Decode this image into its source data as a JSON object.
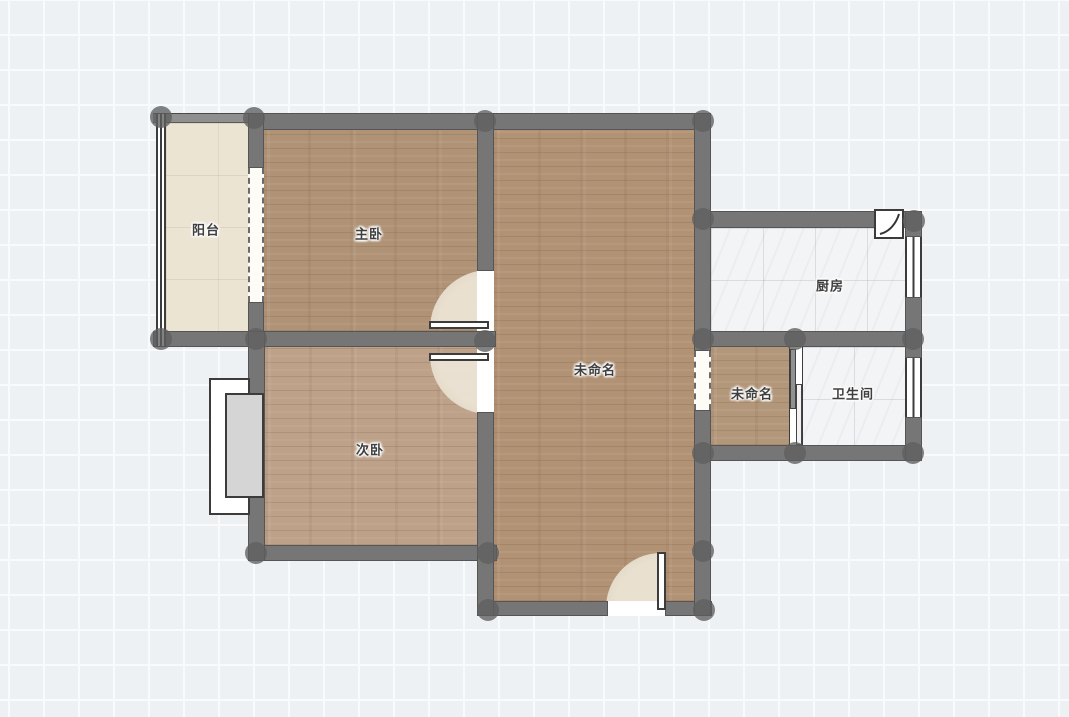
{
  "canvas": {
    "type": "floor-plan-editor-canvas",
    "grid_cell_px": 35
  },
  "rooms": {
    "balcony": {
      "label": "阳台",
      "floor_material": "cream-tile"
    },
    "master_bedroom": {
      "label": "主卧",
      "floor_material": "wood-plank"
    },
    "second_bedroom": {
      "label": "次卧",
      "floor_material": "wood-plank"
    },
    "living": {
      "label": "未命名",
      "floor_material": "wood-plank"
    },
    "kitchen": {
      "label": "厨房",
      "floor_material": "white-tile"
    },
    "storage": {
      "label": "未命名",
      "floor_material": "wood-plank"
    },
    "bathroom": {
      "label": "卫生间",
      "floor_material": "white-tile"
    }
  },
  "colors": {
    "background": "#eef1f4",
    "grid_line": "#f8fafb",
    "wall": "#767676",
    "wall_thin": "#8f8f8f",
    "wall_edge": "#3c3c3c",
    "joint_dot": "#5f5f5f",
    "wood_floor": "#b2967a",
    "cream_floor": "#ece4d3",
    "tile_floor": "#f3f4f6",
    "door_swing": "#e9e0d0",
    "bay_window_sill": "#d5d5d5"
  }
}
